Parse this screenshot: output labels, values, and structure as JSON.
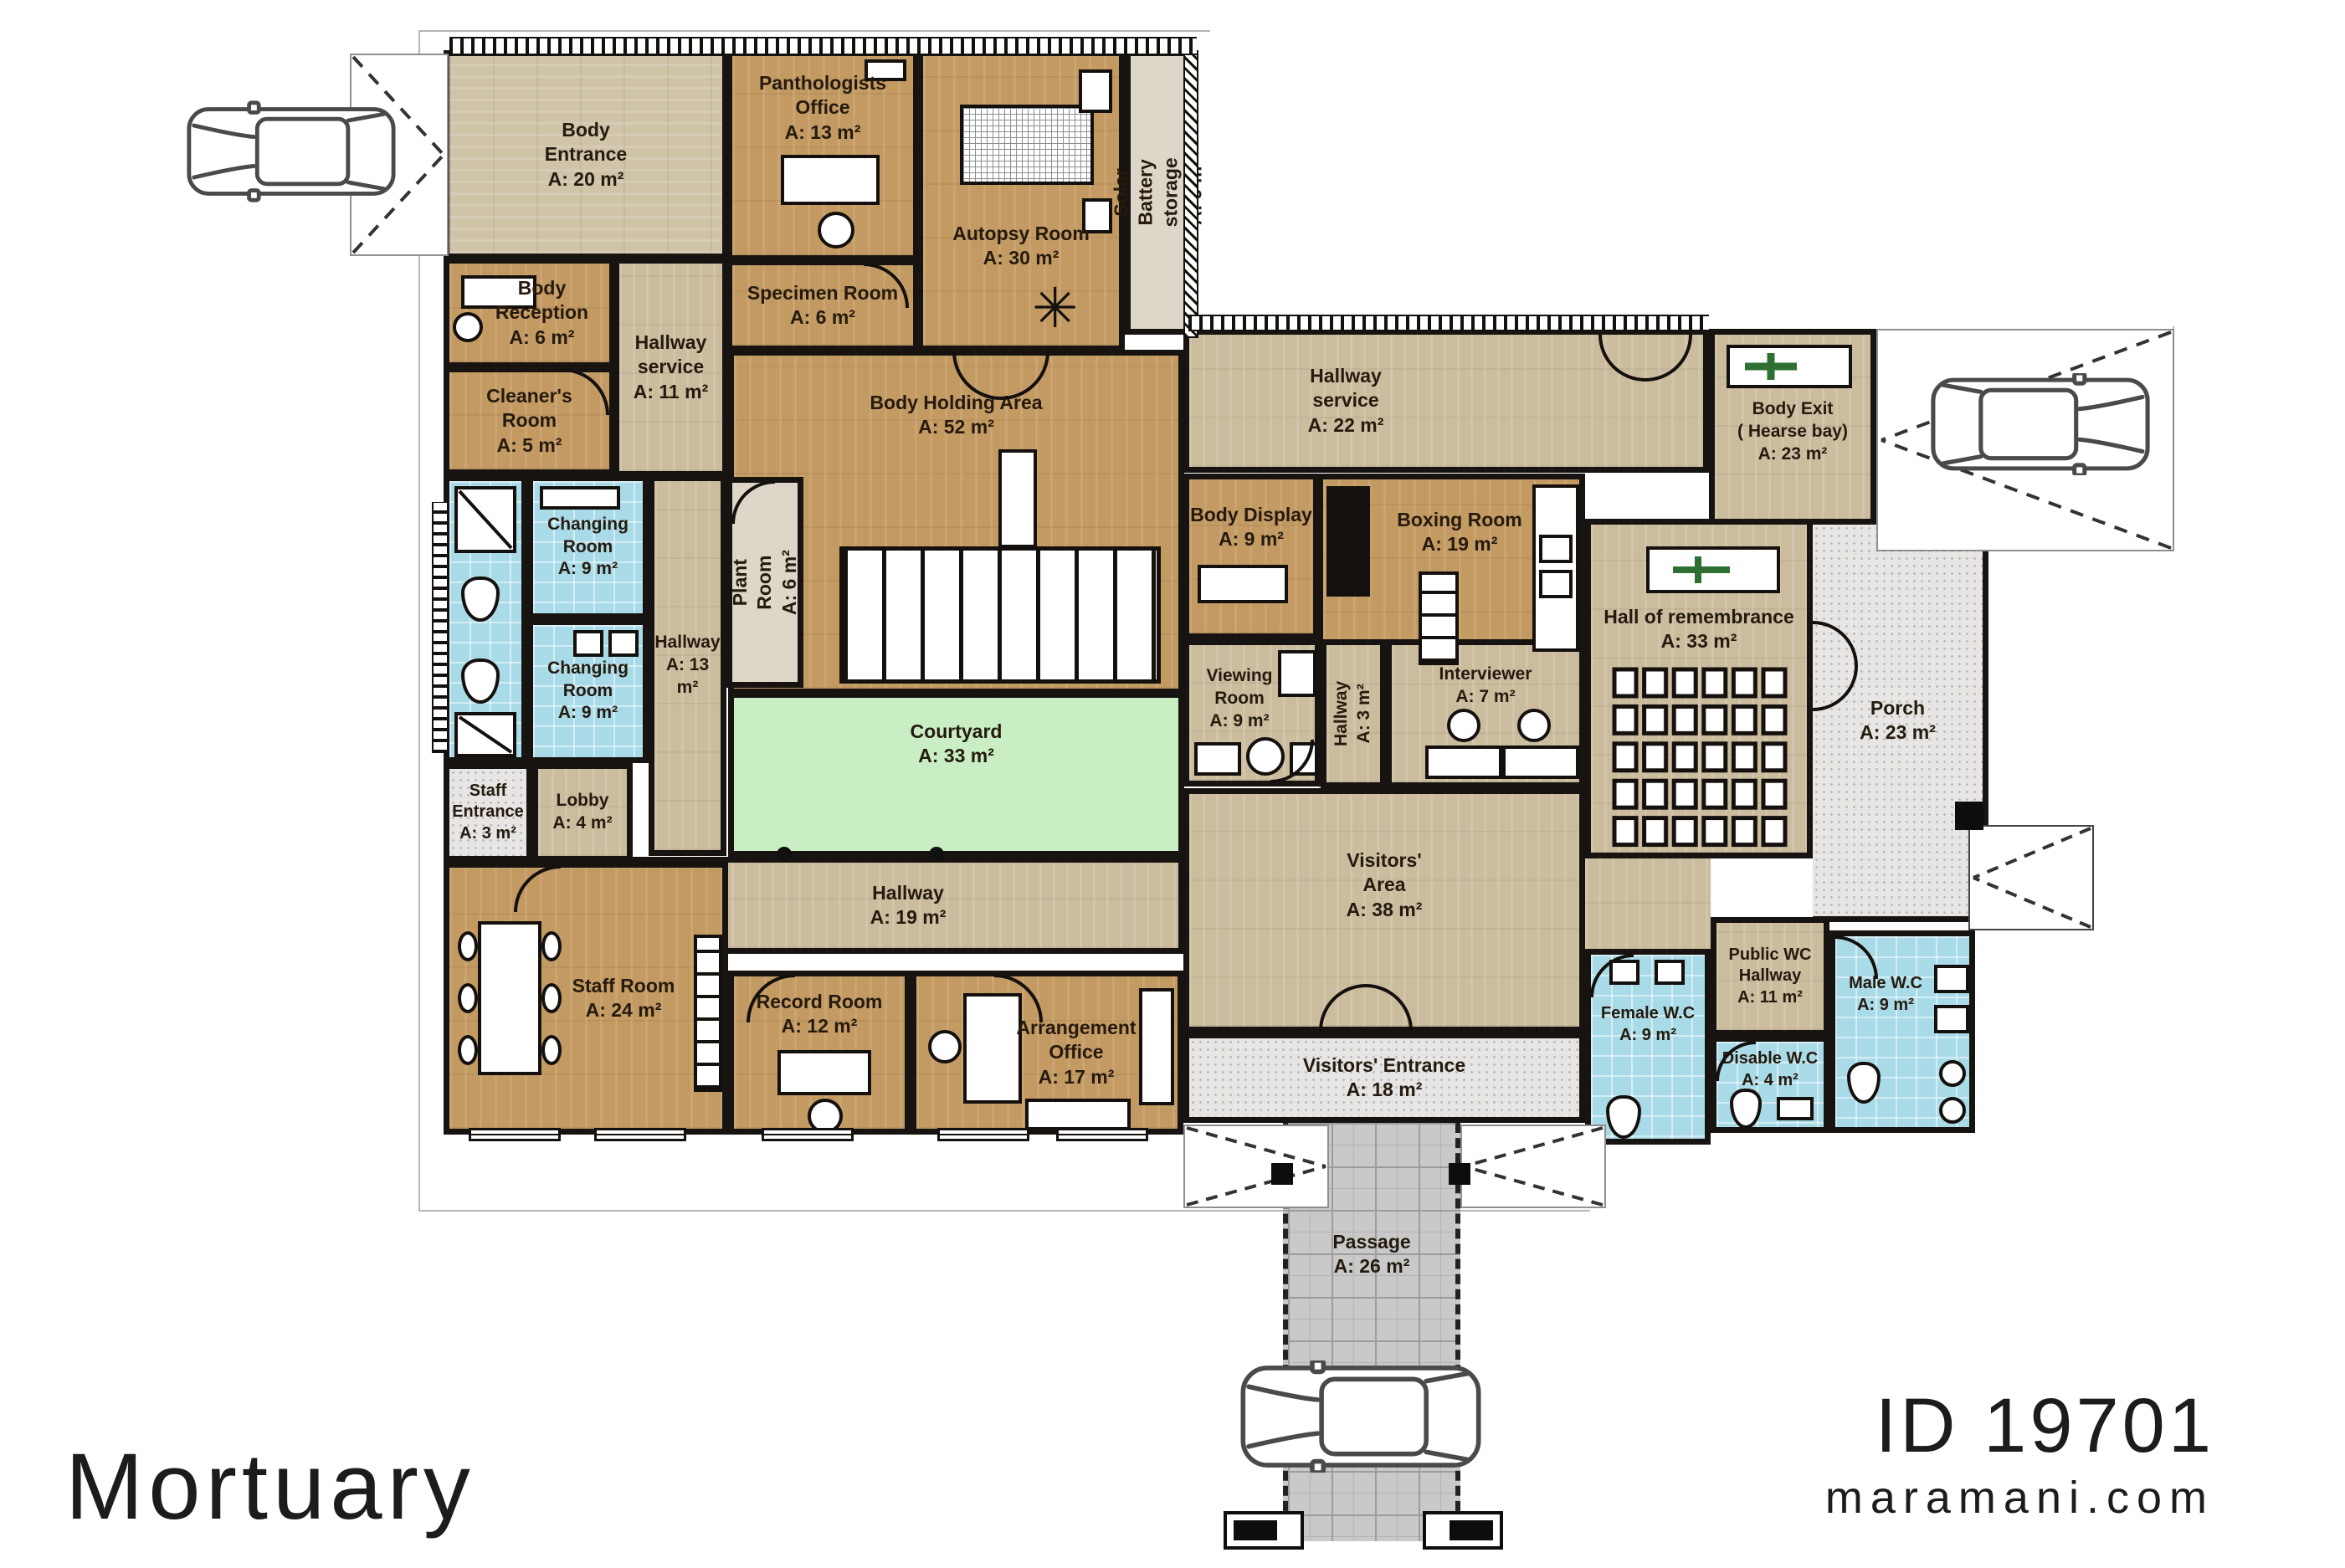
{
  "branding": {
    "title": "Mortuary",
    "plan_id": "ID 19701",
    "website": "maramani.com"
  },
  "palette": {
    "wall": "#171310",
    "wood": "#c49a63",
    "wood_light": "#cbbc9e",
    "tile_blue": "#a9dae8",
    "courtyard_green": "#c9eec3",
    "outdoor_gray": "#e7e6e4",
    "paver_gray": "#c9c9c9",
    "cross_green": "#2e7031"
  },
  "rooms": [
    {
      "id": "body-entrance",
      "name": "Body\nEntrance",
      "area": "A: 20 m²"
    },
    {
      "id": "panthologists-office",
      "name": "Panthologists\nOffice",
      "area": "A: 13 m²"
    },
    {
      "id": "autopsy-room",
      "name": "Autopsy Room",
      "area": "A: 30 m²"
    },
    {
      "id": "specimen-room",
      "name": "Specimen Room",
      "area": "A: 6 m²"
    },
    {
      "id": "body-reception",
      "name": "Body\nReception",
      "area": "A: 6 m²"
    },
    {
      "id": "cleaners-room",
      "name": "Cleaner's\nRoom",
      "area": "A: 5 m²"
    },
    {
      "id": "hallway-service-11",
      "name": "Hallway\nservice",
      "area": "A: 11 m²"
    },
    {
      "id": "solar-battery-storage",
      "name": "Solar Battery storage",
      "area": "A: 9 m²"
    },
    {
      "id": "body-holding-area",
      "name": "Body Holding Area",
      "area": "A: 52 m²"
    },
    {
      "id": "hallway-service-22",
      "name": "Hallway\nservice",
      "area": "A: 22 m²"
    },
    {
      "id": "body-exit",
      "name": "Body Exit\n( Hearse bay)",
      "area": "A: 23 m²"
    },
    {
      "id": "changing-room-1",
      "name": "Changing\nRoom",
      "area": "A: 9 m²"
    },
    {
      "id": "changing-room-2",
      "name": "Changing\nRoom",
      "area": "A: 9 m²"
    },
    {
      "id": "hallway-13",
      "name": "Hallway",
      "area": "A: 13 m²"
    },
    {
      "id": "plant-room",
      "name": "Plant Room",
      "area": "A: 6 m²"
    },
    {
      "id": "body-display",
      "name": "Body Display",
      "area": "A: 9 m²"
    },
    {
      "id": "boxing-room",
      "name": "Boxing Room",
      "area": "A: 19 m²"
    },
    {
      "id": "hall-of-remembrance",
      "name": "Hall of remembrance",
      "area": "A: 33 m²"
    },
    {
      "id": "porch",
      "name": "Porch",
      "area": "A: 23 m²"
    },
    {
      "id": "viewing-room",
      "name": "Viewing\nRoom",
      "area": "A: 9 m²"
    },
    {
      "id": "hallway-3",
      "name": "Hallway",
      "area": "A: 3 m²"
    },
    {
      "id": "interviewer",
      "name": "Interviewer",
      "area": "A: 7 m²"
    },
    {
      "id": "staff-entrance",
      "name": "Staff\nEntrance",
      "area": "A: 3 m²"
    },
    {
      "id": "lobby",
      "name": "Lobby",
      "area": "A: 4 m²"
    },
    {
      "id": "courtyard",
      "name": "Courtyard",
      "area": "A: 33 m²"
    },
    {
      "id": "hallway-19",
      "name": "Hallway",
      "area": "A: 19 m²"
    },
    {
      "id": "visitors-area",
      "name": "Visitors'\nArea",
      "area": "A: 38 m²"
    },
    {
      "id": "public-wc-hallway",
      "name": "Public WC\nHallway",
      "area": "A: 11 m²"
    },
    {
      "id": "female-wc",
      "name": "Female W.C",
      "area": "A: 9 m²"
    },
    {
      "id": "male-wc",
      "name": "Male W.C",
      "area": "A: 9 m²"
    },
    {
      "id": "disable-wc",
      "name": "Disable W.C",
      "area": "A: 4 m²"
    },
    {
      "id": "staff-room",
      "name": "Staff Room",
      "area": "A: 24 m²"
    },
    {
      "id": "record-room",
      "name": "Record Room",
      "area": "A: 12 m²"
    },
    {
      "id": "arrangement-office",
      "name": "Arrangement\nOffice",
      "area": "A: 17 m²"
    },
    {
      "id": "visitors-entrance",
      "name": "Visitors' Entrance",
      "area": "A: 18 m²"
    },
    {
      "id": "passage",
      "name": "Passage",
      "area": "A: 26 m²"
    }
  ]
}
